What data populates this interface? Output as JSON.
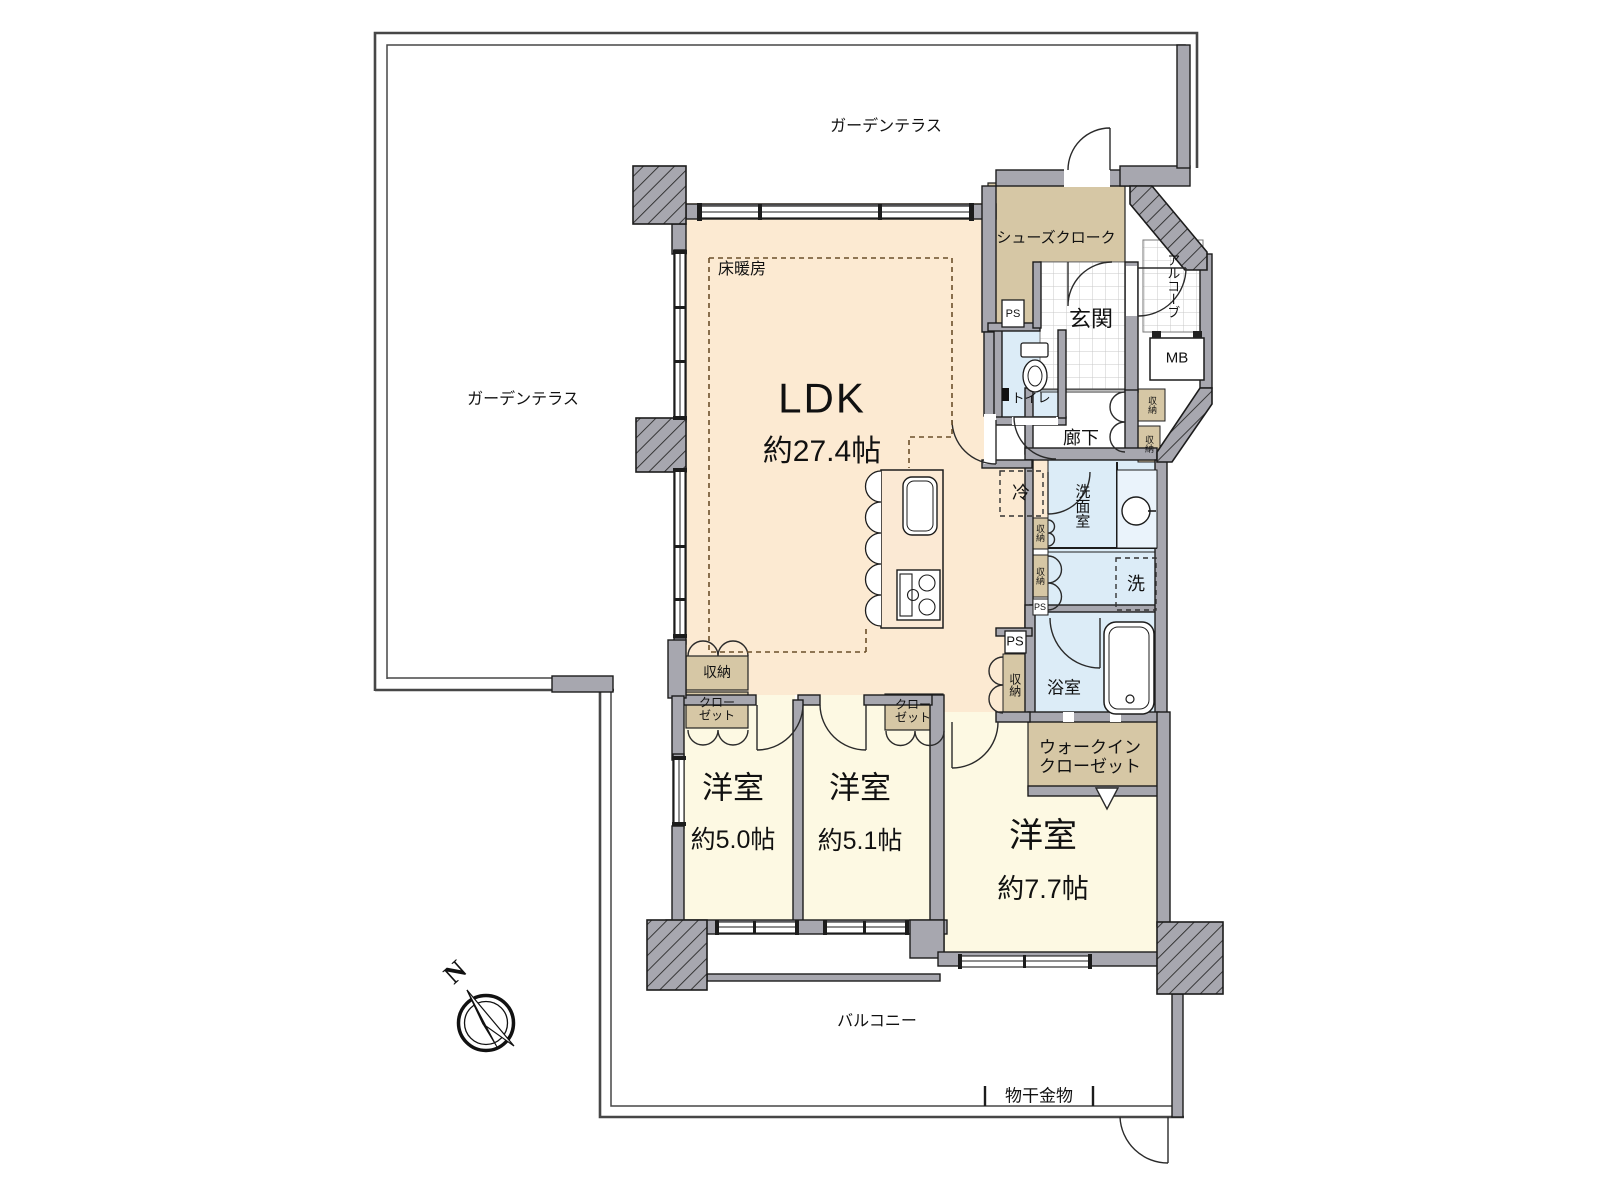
{
  "title": "マンション間取り図 (3LDK)",
  "colors": {
    "ldk_floor": "#fcead2",
    "bedroom_floor": "#fdf9e3",
    "wet_area": "#dcecf7",
    "storage": "#d6c7a5",
    "wall": "#a7a7af",
    "line": "#1c1c1c"
  },
  "labels": {
    "terrace_top": "ガーデンテラス",
    "terrace_left": "ガーデンテラス",
    "balcony": "バルコニー",
    "monohoshi": "物干金物",
    "north": "N",
    "ldk": "LDK",
    "ldk_size": "約27.4帖",
    "yukadanbo": "床暖房",
    "fridge": "冷",
    "shoes_cloak": "シューズクローク",
    "alcove": "アルコーブ",
    "mb": "MB",
    "genkan": "玄関",
    "toilet": "トイレ",
    "hall": "廊下",
    "ps": "PS",
    "shunou": "収納",
    "senmenshitsu": "洗面室",
    "laundry": "洗",
    "bath": "浴室",
    "wic_line1": "ウォークイン",
    "wic_line2": "クローゼット",
    "closet_line1": "クロー",
    "closet_line2": "ゼット",
    "bedroom1_name": "洋室",
    "bedroom1_size": "約5.0帖",
    "bedroom2_name": "洋室",
    "bedroom2_size": "約5.1帖",
    "bedroom3_name": "洋室",
    "bedroom3_size": "約7.7帖"
  },
  "rooms": [
    {
      "name": "LDK",
      "size_jo": "約27.4帖",
      "features": [
        "床暖房",
        "冷蔵庫置場"
      ]
    },
    {
      "name": "洋室",
      "size_jo": "約5.0帖",
      "features": [
        "収納",
        "クローゼット"
      ]
    },
    {
      "name": "洋室",
      "size_jo": "約5.1帖",
      "features": [
        "クローゼット"
      ]
    },
    {
      "name": "洋室",
      "size_jo": "約7.7帖",
      "features": [
        "ウォークインクローゼット"
      ]
    },
    {
      "name": "玄関",
      "features": [
        "シューズクローク",
        "アルコーブ",
        "MB"
      ]
    },
    {
      "name": "洗面室",
      "features": [
        "洗濯機置場"
      ]
    },
    {
      "name": "浴室",
      "features": []
    },
    {
      "name": "トイレ",
      "features": []
    },
    {
      "name": "バルコニー",
      "features": [
        "物干金物"
      ]
    },
    {
      "name": "ガーデンテラス",
      "features": []
    }
  ]
}
